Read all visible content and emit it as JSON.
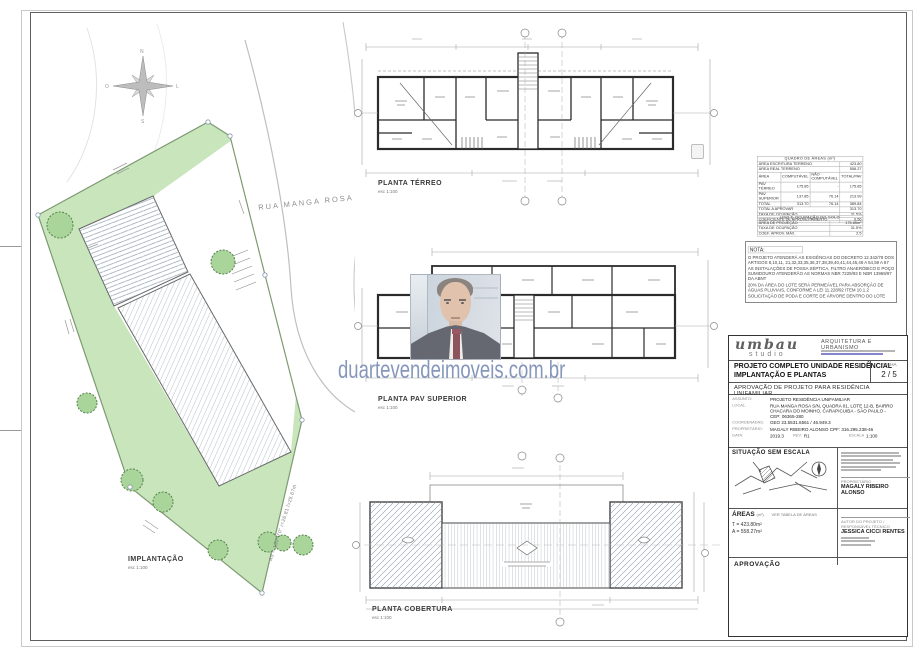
{
  "watermark": {
    "text": "duartevendeimoveis.com.br"
  },
  "site": {
    "street": "RUA MANGA ROSA",
    "label": "IMPLANTAÇÃO",
    "scale": "esc 1:100",
    "edge_note": "Ad = 150°0'0\"  r=26.81  l=25.67m"
  },
  "plans": {
    "terreo": {
      "label": "PLANTA TÉRREO",
      "scale": "esc 1:100"
    },
    "superior": {
      "label": "PLANTA PAV SUPERIOR",
      "scale": "esc 1:100"
    },
    "cobertura": {
      "label": "PLANTA COBERTURA",
      "scale": "esc 1:100"
    }
  },
  "areas_table": {
    "title": "QUADRO DE ÁREAS (m²)",
    "pre_rows": [
      [
        "ÁREA ESCRITURA TERRENO",
        "423.80"
      ],
      [
        "ÁREA REAL TERRENO",
        "558.27"
      ]
    ],
    "header": [
      "ÁREA",
      "COMPUTÁVEL",
      "NÃO COMPUTÁVEL",
      "TOTAL/PAV"
    ],
    "rows": [
      [
        "PAV TÉRREO",
        "175.85",
        "-",
        "175.85"
      ],
      [
        "PAV SUPERIOR",
        "137.85",
        "76.14",
        "213.99"
      ],
      [
        "TOTAL",
        "313.70",
        "76.14",
        "389.84"
      ]
    ],
    "post_rows": [
      [
        "TOTAL A APROVAR",
        "313.70"
      ],
      [
        "TAXA DE OCUPAÇÃO",
        "31.5%"
      ],
      [
        "COEFICIENTE DE APROVEITAMENTO",
        "0.56"
      ]
    ]
  },
  "solo_table": {
    "title": "USO E OCUPAÇÃO DO SOLO",
    "rows": [
      [
        "ÁREA DE PROJEÇÃO",
        "175.85m²"
      ],
      [
        "TAXA DE OCUPAÇÃO",
        "31.5%"
      ],
      [
        "COEF. APROV. MÁX.",
        "2.5"
      ]
    ]
  },
  "nota": {
    "title": "NOTA:",
    "items": [
      "O PROJETO ATENDERÁ AS EXIGÊNCIAS DO DECRETO 12.342/78 DOS ARTIGOS 8,10,11, 21,32,33,35,36,37,38,39,40,41,44,45,49 A 54,59 A 67",
      "AS INSTALAÇÕES DE FOSSA SÉPTICA, FILTRO ANAERÓBICO E POÇO SUMIDOURO ATENDERÃO AS NORMAS NBR 7229/93 E NBR 13969/97 DA ABNT",
      "20% DA ÁREA DO LOTE SERÁ PERMEÁVEL PARA ABSORÇÃO DE ÁGUAS PLUVIAIS, CONFORME A LEI 11.228/92 ITEM 10.1.2",
      "SOLICITAÇÃO DE PODA E CORTE DE ÁRVORE DENTRO DO LOTE"
    ]
  },
  "titleblock": {
    "logo": "umbau",
    "logo_sub": "studio",
    "firm": "ARQUITETURA E URBANISMO",
    "folha_label": "FOLHA",
    "folha_value": "2 / 5",
    "project_title_1": "PROJETO COMPLETO UNIDADE RESIDÊNCIAL",
    "project_title_2": "IMPLANTAÇÃO E PLANTAS",
    "approval_line": "APROVAÇÃO DE PROJETO PARA RESIDÊNCIA UNIFAMILIAR",
    "fields": [
      {
        "label": "ASSUNTO:",
        "value": "PROJETO RESIDÊNCIA UNIFAMILIAR"
      },
      {
        "label": "LOCAL:",
        "value": "RUA MANGA ROSA S/N, QUADRA 01, LOTE 12-B, BAIRRO CHACARA DO MOINHO, CARAPICUIBA - SÃO PAULO - CEP: 06365-280"
      },
      {
        "label": "COORDENADAS:",
        "value": "GEO 23.5531.6561 / 46.949.3"
      },
      {
        "label": "PROPRIETÁRIO:",
        "value": "MAGALY RIBEIRO ALONSO   CPF: 316.295.238-46"
      },
      {
        "label": "DATA:",
        "value": "2019.3"
      }
    ],
    "rev_label": "REV:",
    "rev_value": "R1",
    "escala_label": "ESCALA",
    "escala_value": "1:100",
    "situacao_title": "SITUAÇÃO SEM ESCALA",
    "owner_label": "PROPRIETÁRIO",
    "owner_name": "MAGALY RIBEIRO ALONSO",
    "areas_title": "ÁREAS",
    "areas_unit": "(m²)",
    "areas_note": "VER TABELA DE ÁREAS",
    "areas_lines": [
      "T = 423.80m²",
      "A = 558.27m²"
    ],
    "author_label": "AUTOR DO PROJETO / RESPONSÁVEL TÉCNICO",
    "author_name": "JESSICA CICCI RENTES",
    "approval_title": "APROVAÇÃO"
  }
}
